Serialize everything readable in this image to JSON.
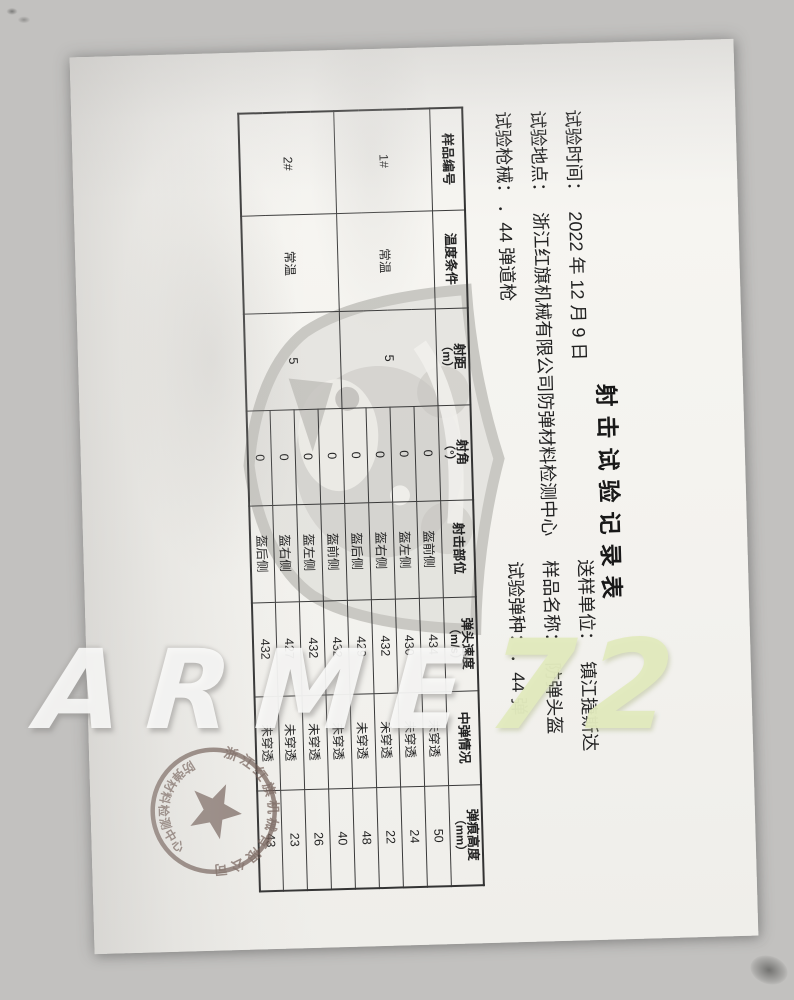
{
  "doc": {
    "title": "射击试验记录表",
    "info_left": [
      {
        "label": "试验时间：",
        "value": "2022 年 12 月 9 日"
      },
      {
        "label": "试验地点：",
        "value": "浙江红旗机械有限公司防弹材料检测中心"
      },
      {
        "label": "试验枪械：",
        "value": "．44 弹道枪"
      }
    ],
    "info_right": [
      {
        "label": "送样单位：",
        "value": "镇江捷斯达"
      },
      {
        "label": "样品名称：",
        "value": "防弹头盔"
      },
      {
        "label": "试验弹种：",
        "value": "．44 弹"
      }
    ],
    "table": {
      "headers": [
        [
          "样品编号",
          ""
        ],
        [
          "温度条件",
          ""
        ],
        [
          "射距",
          "（m）"
        ],
        [
          "射角",
          "（°）"
        ],
        [
          "射击部位",
          ""
        ],
        [
          "弹头速度",
          "（m/s）"
        ],
        [
          "中弹情况",
          ""
        ],
        [
          "弹痕高度",
          "（mm）"
        ]
      ],
      "groups": [
        {
          "sample": "1#",
          "temperature": "常温",
          "distance": "5",
          "shots": [
            {
              "angle": "0",
              "position": "盔前侧",
              "velocity": "434",
              "result": "未穿透",
              "height": "50"
            },
            {
              "angle": "0",
              "position": "盔左侧",
              "velocity": "430",
              "result": "未穿透",
              "height": "24"
            },
            {
              "angle": "0",
              "position": "盔右侧",
              "velocity": "432",
              "result": "未穿透",
              "height": "22"
            },
            {
              "angle": "0",
              "position": "盔后侧",
              "velocity": "429",
              "result": "未穿透",
              "height": "48"
            }
          ]
        },
        {
          "sample": "2#",
          "temperature": "常温",
          "distance": "5",
          "shots": [
            {
              "angle": "0",
              "position": "盔前侧",
              "velocity": "432",
              "result": "未穿透",
              "height": "40"
            },
            {
              "angle": "0",
              "position": "盔左侧",
              "velocity": "432",
              "result": "未穿透",
              "height": "26"
            },
            {
              "angle": "0",
              "position": "盔右侧",
              "velocity": "427",
              "result": "未穿透",
              "height": "23"
            },
            {
              "angle": "0",
              "position": "盔后侧",
              "velocity": "432",
              "result": "未穿透",
              "height": "43"
            }
          ]
        }
      ]
    },
    "stamp": {
      "arc_top": "浙江红旗机械有限公司",
      "arc_bottom": "防弹材料检测中心"
    }
  },
  "watermark": {
    "white": "ARME",
    "yellow": "72"
  },
  "colors": {
    "stamp": "#6e5952",
    "watermark_white": "#fbfbf9",
    "watermark_yellow": "#e1eabe",
    "paper": "#f5f4f0",
    "ink": "#1f1f1f"
  }
}
